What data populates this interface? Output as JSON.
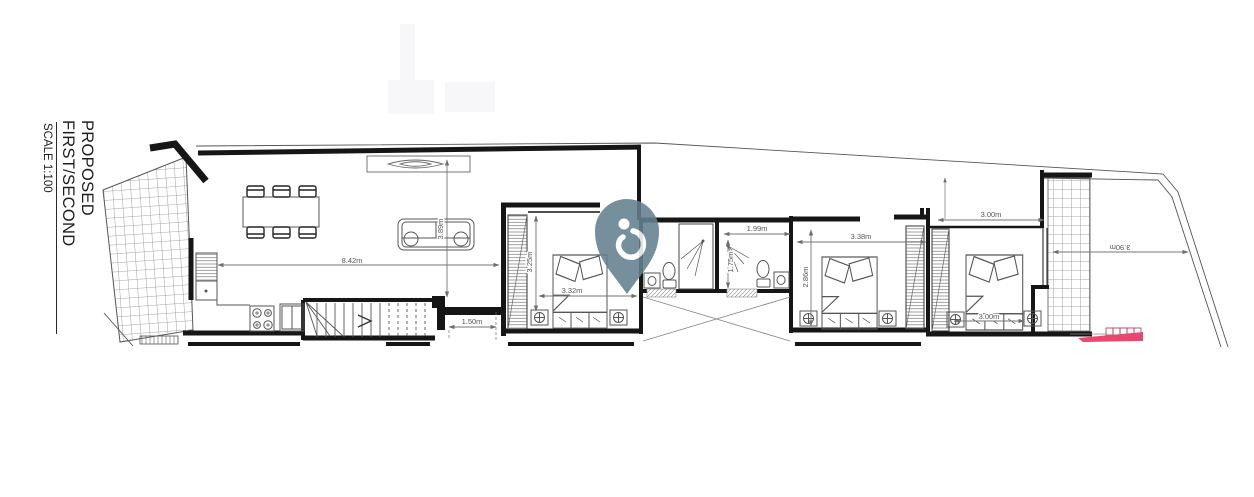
{
  "title_block": {
    "title": "PROPOSED FIRST/SECOND",
    "scale": "SCALE 1:100"
  },
  "watermark": {
    "icon": "location-pin-logo",
    "color": "#64808f"
  },
  "colors": {
    "wall": "#161616",
    "furniture": "#555555",
    "dimension": "#757575",
    "hatch": "#8a8a8a",
    "accent_pink": "#e8486e",
    "background": "#ffffff"
  },
  "dims": {
    "living_width": "8.42m",
    "living_depth": "3.89m",
    "hall_width": "1.50m",
    "bedroom1_depth": "3.25m",
    "bedroom1_width": "3.32m",
    "bathroom2_width": "1.99m",
    "bathroom2_depth": "1.75m",
    "bedroom2_width": "3.38m",
    "bedroom2_depth": "2.86m",
    "bedroom3_width": "3.00m",
    "bedroom3_bed_width": "3.00m",
    "rear_terrace_width": "3.90m"
  }
}
